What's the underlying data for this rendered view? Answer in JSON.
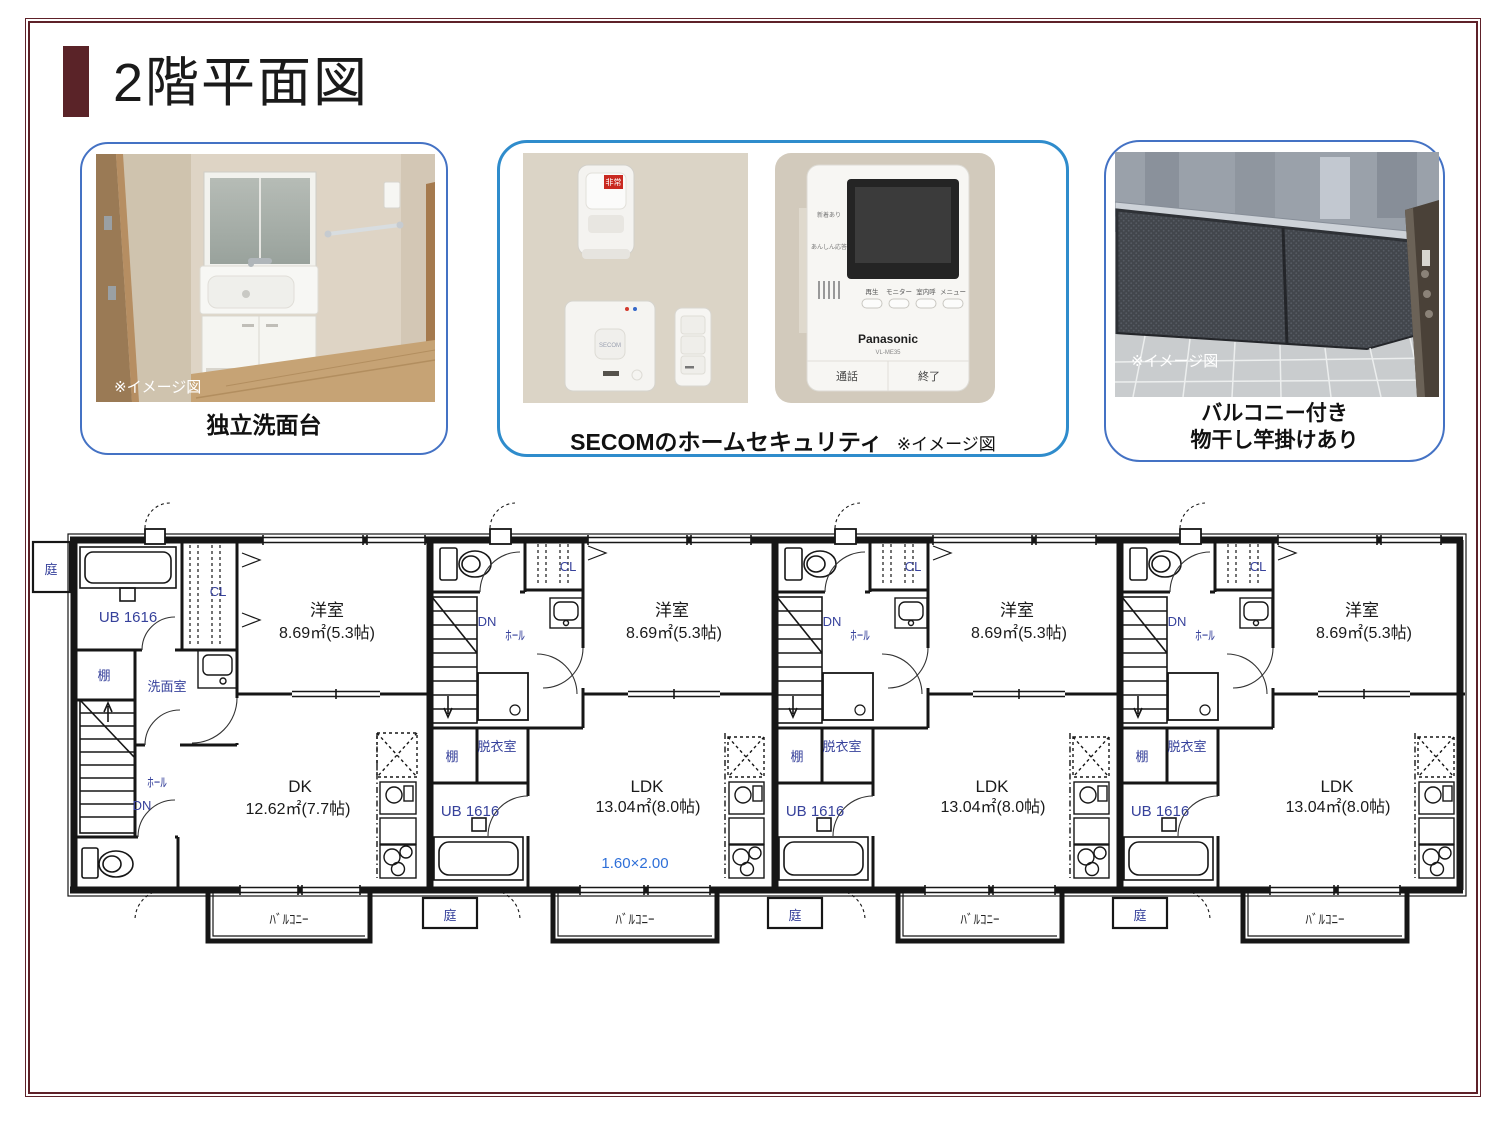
{
  "page": {
    "title": "2階平面図"
  },
  "boxes": {
    "washstand": {
      "caption": "独立洗面台",
      "watermark": "※イメージ図"
    },
    "security": {
      "caption": "SECOMのホームセキュリティ",
      "note": "※イメージ図",
      "sensor_label": "非常",
      "logo": "SECOM",
      "intercom": {
        "status1": "新着あり",
        "status2": "あんしん応答",
        "buttons": [
          "再生",
          "モニター",
          "室内呼",
          "メニュー"
        ],
        "brand": "Panasonic",
        "model": "VL-ME35",
        "talk": "通話",
        "end": "終了"
      }
    },
    "balcony": {
      "caption1": "バルコニー付き",
      "caption2": "物干し竿掛けあり",
      "watermark": "※イメージ図"
    }
  },
  "floor_plan": {
    "units": [
      {
        "labels": {
          "yard": "庭",
          "ub": "UB 1616",
          "cl": "CL",
          "west": "洋室",
          "west_size": "8.69㎡(5.3帖)",
          "shelf": "棚",
          "wash": "洗面室",
          "hall": "ﾎｰﾙ",
          "dn": "DN",
          "main": "DK",
          "main_size": "12.62㎡(7.7帖)",
          "balcony": "ﾊﾞﾙｺﾆｰ"
        }
      },
      {
        "labels": {
          "cl": "CL",
          "west": "洋室",
          "west_size": "8.69㎡(5.3帖)",
          "dn": "DN",
          "hall": "ﾎｰﾙ",
          "shelf": "棚",
          "dressing": "脱衣室",
          "ub": "UB 1616",
          "main": "LDK",
          "main_size": "13.04㎡(8.0帖)",
          "dim": "1.60×2.00",
          "balcony": "ﾊﾞﾙｺﾆｰ",
          "yard": "庭"
        }
      },
      {
        "labels": {
          "cl": "CL",
          "west": "洋室",
          "west_size": "8.69㎡(5.3帖)",
          "dn": "DN",
          "hall": "ﾎｰﾙ",
          "shelf": "棚",
          "dressing": "脱衣室",
          "ub": "UB 1616",
          "main": "LDK",
          "main_size": "13.04㎡(8.0帖)",
          "balcony": "ﾊﾞﾙｺﾆｰ",
          "yard": "庭"
        }
      },
      {
        "labels": {
          "cl": "CL",
          "west": "洋室",
          "west_size": "8.69㎡(5.3帖)",
          "dn": "DN",
          "hall": "ﾎｰﾙ",
          "shelf": "棚",
          "dressing": "脱衣室",
          "ub": "UB 1616",
          "main": "LDK",
          "main_size": "13.04㎡(8.0帖)",
          "balcony": "ﾊﾞﾙｺﾆｰ",
          "yard": "庭"
        }
      }
    ]
  }
}
